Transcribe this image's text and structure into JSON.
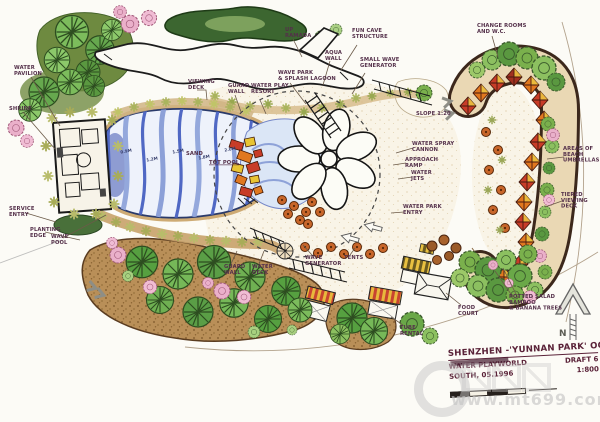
{
  "plan": {
    "title_block": {
      "project": "SHENZHEN -'YUNNAN PARK' OCT",
      "subtitle": "WATER PLAYWORLD",
      "draft": "DRAFT 6",
      "issue": "SOUTH, 05.1996",
      "scale": "1:800"
    },
    "north_label": "N",
    "watermark_url": "www.mt699.com",
    "labels": [
      "UP\nRAMADA",
      "WAVE PARK\n& SPLASH LAGOON",
      "FUN CAVE\nSTRUCTURE",
      "AQUA\nWALL",
      "SMALL WAVE\nGENERATOR",
      "VIEWING\nDECK",
      "GUARD\nWALL",
      "WATER PLAY\nRESORT",
      "CHANGE ROOMS\nAND W.C.",
      "WATER\nPAVILION",
      "SHRINE",
      "SERVICE\nENTRY",
      "PLANTING\nEDGE",
      "WAVE\nPOOL",
      "SAND",
      "TOT POOL",
      "WATER SPRAY\nCANNON",
      "APPROACH\nRAMP",
      "WATER\nJETS",
      "WATER PARK\nENTRY",
      "AREAS OF\nBEACH\nUMBRELLAS",
      "TIERED\nVIEWING\nDECK",
      "FOOD\nCOURT",
      "POTTED SALAD\nBAMBOO\n& BANANA TREES",
      "GUARD\nWALL",
      "WATER\nDECK",
      "WAVE\nGENERATOR",
      "TENTS",
      "TUBE\nRENTAL",
      "SLOPE 1:20"
    ],
    "depth_markers": [
      "0.9M",
      "1.2M",
      "1.5M",
      "1.8M",
      "2.0M"
    ],
    "colors": {
      "paper": "#fcfbf6",
      "water": "#5068c4",
      "canopy_red": "#c83c28",
      "canopy_orange": "#e07820",
      "canopy_yellow": "#e8c433",
      "foliage": "#66a84e",
      "blossom": "#eab0ca",
      "ink": "#54304a"
    }
  }
}
